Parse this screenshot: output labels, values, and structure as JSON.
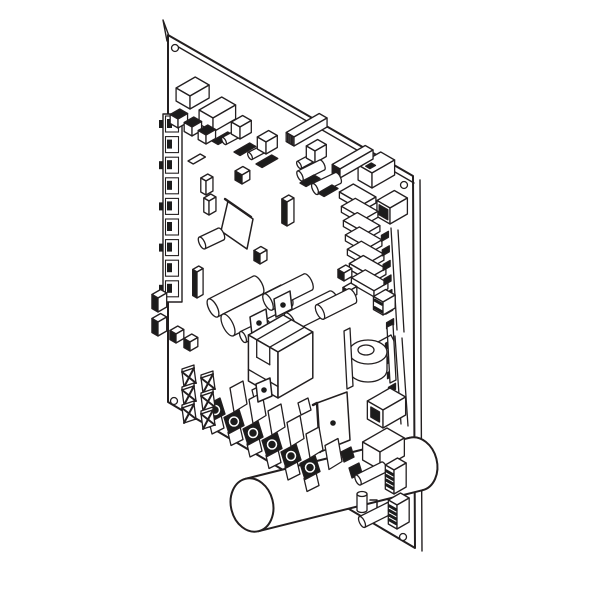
{
  "figure": {
    "alt": "Isometric black-and-white technical line drawing of an electronic control circuit board with relays, capacitors, a transformer, heat-sink stack, screw terminal strip, spade terminals and a large cylindrical capacitor",
    "colors": {
      "background": "#ffffff",
      "line": "#231f20",
      "dark_fill": "#1c1c1c",
      "white_fill": "#ffffff"
    },
    "components": [
      {
        "name": "circuit-board-panel",
        "type": "board",
        "outline": [
          [
            168,
            35
          ],
          [
            413,
            176
          ],
          [
            415,
            548
          ],
          [
            168,
            402
          ]
        ],
        "edge_top": [
          [
            175,
            45
          ],
          [
            414,
            183
          ]
        ],
        "edge_right": [
          [
            420,
            180
          ],
          [
            422,
            551
          ]
        ],
        "corner_tab": [
          [
            169,
            36
          ],
          [
            163,
            20
          ],
          [
            167,
            41
          ]
        ],
        "holes": [
          [
            175,
            48
          ],
          [
            404,
            185
          ],
          [
            403,
            537
          ],
          [
            174,
            401
          ]
        ],
        "hole_r": 3.5
      },
      {
        "name": "edge-connector-strip-left",
        "type": "leftstrip",
        "x": 163,
        "y": 114,
        "cells": 9,
        "step": 20.6
      },
      {
        "name": "relay-box-1",
        "type": "isobox",
        "x": 190,
        "y": 96,
        "da": 16,
        "db": 22,
        "h": 13
      },
      {
        "name": "relay-box-2",
        "type": "isobox",
        "x": 213,
        "y": 118,
        "da": 16,
        "db": 26,
        "h": 14
      },
      {
        "name": "cap-cube-1",
        "type": "isobox",
        "x": 178,
        "y": 119,
        "da": 9,
        "db": 11,
        "h": 9,
        "topDark": true
      },
      {
        "name": "cap-cube-2",
        "type": "isobox",
        "x": 192,
        "y": 127,
        "da": 9,
        "db": 11,
        "h": 9,
        "topDark": true
      },
      {
        "name": "cap-cube-3",
        "type": "isobox",
        "x": 206,
        "y": 135,
        "da": 9,
        "db": 11,
        "h": 9,
        "topDark": true
      },
      {
        "name": "diode-chip-1",
        "type": "chip",
        "x": 212,
        "y": 141,
        "da": 7,
        "db": 18
      },
      {
        "name": "diode-chip-2",
        "type": "chip",
        "x": 234,
        "y": 152,
        "da": 7,
        "db": 18
      },
      {
        "name": "diode-chip-3",
        "type": "chip",
        "x": 256,
        "y": 164,
        "da": 7,
        "db": 18
      },
      {
        "name": "trimpot-cube-1",
        "type": "isobox",
        "x": 240,
        "y": 127,
        "da": 10,
        "db": 13,
        "h": 12,
        "peg": [
          [
            224,
            141
          ],
          [
            239,
            133
          ]
        ]
      },
      {
        "name": "trimpot-cube-2",
        "type": "isobox",
        "x": 266,
        "y": 142,
        "da": 10,
        "db": 13,
        "h": 12,
        "peg": [
          [
            250,
            156
          ],
          [
            265,
            148
          ]
        ]
      },
      {
        "name": "smd-chip-white",
        "type": "chip",
        "x": 188,
        "y": 161,
        "da": 6,
        "db": 14,
        "fill": "#ffffff"
      },
      {
        "name": "cap-box-1",
        "type": "isobox",
        "x": 206,
        "y": 181,
        "da": 6,
        "db": 8,
        "h": 14
      },
      {
        "name": "cap-box-2",
        "type": "isobox",
        "x": 209,
        "y": 201,
        "da": 6,
        "db": 8,
        "h": 14
      },
      {
        "name": "smd-cube-1",
        "type": "isobox",
        "x": 242,
        "y": 175,
        "da": 8,
        "db": 9,
        "h": 9,
        "darkLeft": true
      },
      {
        "name": "ic-dip-1",
        "type": "isobox",
        "x": 294,
        "y": 137,
        "da": 9,
        "db": 38,
        "h": 9,
        "hatch": true
      },
      {
        "name": "trimpot-cube-3",
        "type": "isobox",
        "x": 315,
        "y": 151,
        "da": 10,
        "db": 13,
        "h": 12,
        "peg": [
          [
            299,
            165
          ],
          [
            314,
            157
          ]
        ]
      },
      {
        "name": "connector-top-right",
        "type": "isobox",
        "x": 372,
        "y": 173,
        "da": 16,
        "db": 26,
        "h": 15,
        "mark": true
      },
      {
        "name": "ic-dip-2",
        "type": "isobox",
        "x": 340,
        "y": 169,
        "da": 9,
        "db": 38,
        "h": 9,
        "hatch": true,
        "darkLeft": true
      },
      {
        "name": "cap-cyl-small-1",
        "type": "hcyl",
        "x1": 300,
        "y1": 176,
        "x2": 322,
        "y2": 165,
        "r": 5.5
      },
      {
        "name": "cap-cyl-small-2",
        "type": "hcyl",
        "x1": 315,
        "y1": 189,
        "x2": 338,
        "y2": 178,
        "r": 6
      },
      {
        "name": "diode-chip-4",
        "type": "chip",
        "x": 300,
        "y": 183,
        "da": 7,
        "db": 16
      },
      {
        "name": "diode-chip-5",
        "type": "chip",
        "x": 318,
        "y": 193,
        "da": 7,
        "db": 16
      },
      {
        "name": "relay-top-right",
        "type": "isobox",
        "x": 390,
        "y": 208,
        "da": 15,
        "db": 20,
        "h": 16,
        "frontHole": true
      },
      {
        "name": "heat-sink-stack",
        "type": "heatsink",
        "x": 362,
        "y": 205,
        "n": 7,
        "dx": 2,
        "dy": 14.3,
        "da": 26,
        "db": 16,
        "h": 6
      },
      {
        "name": "smd-cube-2",
        "type": "isobox",
        "x": 344,
        "y": 273,
        "da": 7,
        "db": 9,
        "h": 8,
        "darkLeft": true
      },
      {
        "name": "smd-cube-3",
        "type": "isobox",
        "x": 349,
        "y": 291,
        "da": 7,
        "db": 9,
        "h": 8,
        "darkLeft": true
      },
      {
        "name": "pin-header-strip-1",
        "type": "pinstrip",
        "x1": 391,
        "y1": 228,
        "x2": 397,
        "y2": 330,
        "n": 7
      },
      {
        "name": "pin-header-strip-2",
        "type": "pinstrip",
        "x1": 395,
        "y1": 336,
        "x2": 401,
        "y2": 424,
        "n": 6
      },
      {
        "name": "terminal-block-3pin",
        "type": "isobox",
        "x": 383,
        "y": 302,
        "da": 11,
        "db": 14,
        "h": 13,
        "ribs": 2
      },
      {
        "name": "ic-chip-plate",
        "type": "plate",
        "pts": [
          [
            228,
            201
          ],
          [
            253,
            219
          ],
          [
            247,
            249
          ],
          [
            221,
            231
          ]
        ],
        "edge": [
          [
            225,
            199
          ],
          [
            251,
            217
          ]
        ]
      },
      {
        "name": "cap-cyl-3",
        "type": "hcyl",
        "x1": 202,
        "y1": 243,
        "x2": 221,
        "y2": 234,
        "r": 6.5
      },
      {
        "name": "smd-cube-4",
        "type": "isobox",
        "x": 260,
        "y": 254,
        "da": 7,
        "db": 8,
        "h": 10,
        "darkLeft": true
      },
      {
        "name": "cap-electrolytic-1",
        "type": "isobox",
        "x": 287,
        "y": 202,
        "da": 6,
        "db": 8,
        "h": 24,
        "darkLeft": true
      },
      {
        "name": "cap-electrolytic-2",
        "type": "isobox",
        "x": 197,
        "y": 272,
        "da": 5,
        "db": 7,
        "h": 26,
        "darkLeft": true
      },
      {
        "name": "film-cap-cyl-1",
        "type": "hcyl",
        "x1": 213,
        "y1": 308,
        "x2": 258,
        "y2": 285,
        "r": 10
      },
      {
        "name": "film-cap-cyl-2",
        "type": "hcyl",
        "x1": 228,
        "y1": 325,
        "x2": 286,
        "y2": 296,
        "r": 12
      },
      {
        "name": "film-cap-cyl-3",
        "type": "hcyl",
        "x1": 268,
        "y1": 302,
        "x2": 308,
        "y2": 282,
        "r": 9
      },
      {
        "name": "film-cap-cyl-4",
        "type": "hcyl",
        "x1": 290,
        "y1": 322,
        "x2": 334,
        "y2": 300,
        "r": 10
      },
      {
        "name": "film-cap-cyl-5",
        "type": "hcyl",
        "x1": 320,
        "y1": 312,
        "x2": 352,
        "y2": 296,
        "r": 8
      },
      {
        "name": "film-cap-cyl-6",
        "type": "hcyl",
        "x1": 243,
        "y1": 337,
        "x2": 268,
        "y2": 325,
        "r": 6
      },
      {
        "name": "mount-tab-1",
        "type": "plate",
        "pts": [
          [
            274,
            299
          ],
          [
            290,
            291
          ],
          [
            292,
            309
          ],
          [
            276,
            317
          ]
        ],
        "hole": [
          283,
          305
        ]
      },
      {
        "name": "mount-tab-2",
        "type": "plate",
        "pts": [
          [
            250,
            317
          ],
          [
            266,
            309
          ],
          [
            268,
            327
          ],
          [
            252,
            335
          ]
        ],
        "hole": [
          259,
          323
        ]
      },
      {
        "name": "transformer",
        "type": "transformer",
        "x": 278,
        "y": 352,
        "da": 34,
        "db": 40,
        "h": 46
      },
      {
        "name": "toroid-inductor",
        "type": "toroid",
        "cx": 368,
        "cy": 352
      },
      {
        "name": "main-filter-capacitor",
        "type": "hcyl",
        "x1": 252,
        "y1": 505,
        "x2": 416,
        "y2": 464,
        "r": 27,
        "ar": 0.78,
        "bold": true
      },
      {
        "name": "power-transistor-plate",
        "type": "plate",
        "pts": [
          [
            317,
            403
          ],
          [
            347,
            392
          ],
          [
            350,
            440
          ],
          [
            320,
            452
          ]
        ],
        "hole": [
          333,
          423
        ],
        "edge": [
          [
            313,
            405
          ],
          [
            317,
            403
          ],
          [
            320,
            452
          ]
        ]
      },
      {
        "name": "screw-terminal-strip",
        "type": "termstrip",
        "x": 214,
        "y": 408,
        "n": 6,
        "dx": 19,
        "dy": 11.5
      },
      {
        "name": "mount-tab-3",
        "type": "plate",
        "pts": [
          [
            256,
            384
          ],
          [
            270,
            378
          ],
          [
            272,
            396
          ],
          [
            258,
            402
          ]
        ],
        "hole": [
          264,
          390
        ]
      },
      {
        "name": "spade-terminal-1",
        "type": "xterm",
        "x": 182,
        "y": 372
      },
      {
        "name": "spade-terminal-2",
        "type": "xterm",
        "x": 201,
        "y": 378
      },
      {
        "name": "spade-terminal-3",
        "type": "xterm",
        "x": 182,
        "y": 390
      },
      {
        "name": "spade-terminal-4",
        "type": "xterm",
        "x": 201,
        "y": 396
      },
      {
        "name": "spade-terminal-5",
        "type": "xterm",
        "x": 182,
        "y": 408
      },
      {
        "name": "spade-terminal-6",
        "type": "xterm",
        "x": 201,
        "y": 414
      },
      {
        "name": "spade-cube-1",
        "type": "isobox",
        "x": 176,
        "y": 334,
        "da": 7,
        "db": 9,
        "h": 9,
        "darkLeft": true
      },
      {
        "name": "spade-cube-2",
        "type": "isobox",
        "x": 190,
        "y": 342,
        "da": 7,
        "db": 9,
        "h": 9,
        "darkLeft": true
      },
      {
        "name": "side-terminal-1",
        "type": "isobox",
        "x": 158,
        "y": 298,
        "da": 7,
        "db": 10,
        "h": 14,
        "darkLeft": true
      },
      {
        "name": "side-terminal-2",
        "type": "isobox",
        "x": 158,
        "y": 322,
        "da": 7,
        "db": 10,
        "h": 14,
        "darkLeft": true
      },
      {
        "name": "relay-bottom-1",
        "type": "isobox",
        "x": 383,
        "y": 410,
        "da": 18,
        "db": 26,
        "h": 18,
        "frontHole": true
      },
      {
        "name": "relay-bottom-2",
        "type": "isobox",
        "x": 380,
        "y": 452,
        "da": 20,
        "db": 28,
        "h": 18
      },
      {
        "name": "contact-clip-1",
        "type": "poly",
        "pts": [
          [
            341,
            452
          ],
          [
            351,
            447
          ],
          [
            354,
            457
          ],
          [
            344,
            462
          ]
        ],
        "fill": "#1c1c1c"
      },
      {
        "name": "contact-clip-2",
        "type": "poly",
        "pts": [
          [
            349,
            468
          ],
          [
            359,
            463
          ],
          [
            362,
            473
          ],
          [
            352,
            478
          ]
        ],
        "fill": "#1c1c1c"
      },
      {
        "name": "jumper-cyl-1",
        "type": "hcyl",
        "x1": 358,
        "y1": 480,
        "x2": 384,
        "y2": 467,
        "r": 5.5
      },
      {
        "name": "standoff-cyl",
        "type": "vcyl",
        "x": 362,
        "y": 494,
        "r": 5,
        "h": 16
      },
      {
        "name": "wire-link",
        "type": "poly",
        "open": true,
        "pts": [
          [
            370,
            500
          ],
          [
            377,
            500
          ],
          [
            377,
            512
          ]
        ]
      },
      {
        "name": "jumper-cyl-2",
        "type": "hcyl",
        "x1": 362,
        "y1": 522,
        "x2": 390,
        "y2": 508,
        "r": 6
      },
      {
        "name": "ribbon-connector-1",
        "type": "isobox",
        "x": 394,
        "y": 470,
        "da": 10,
        "db": 14,
        "h": 24,
        "ribs": 4
      },
      {
        "name": "ribbon-connector-2",
        "type": "isobox",
        "x": 397,
        "y": 505,
        "da": 10,
        "db": 14,
        "h": 24,
        "ribs": 4
      }
    ]
  }
}
